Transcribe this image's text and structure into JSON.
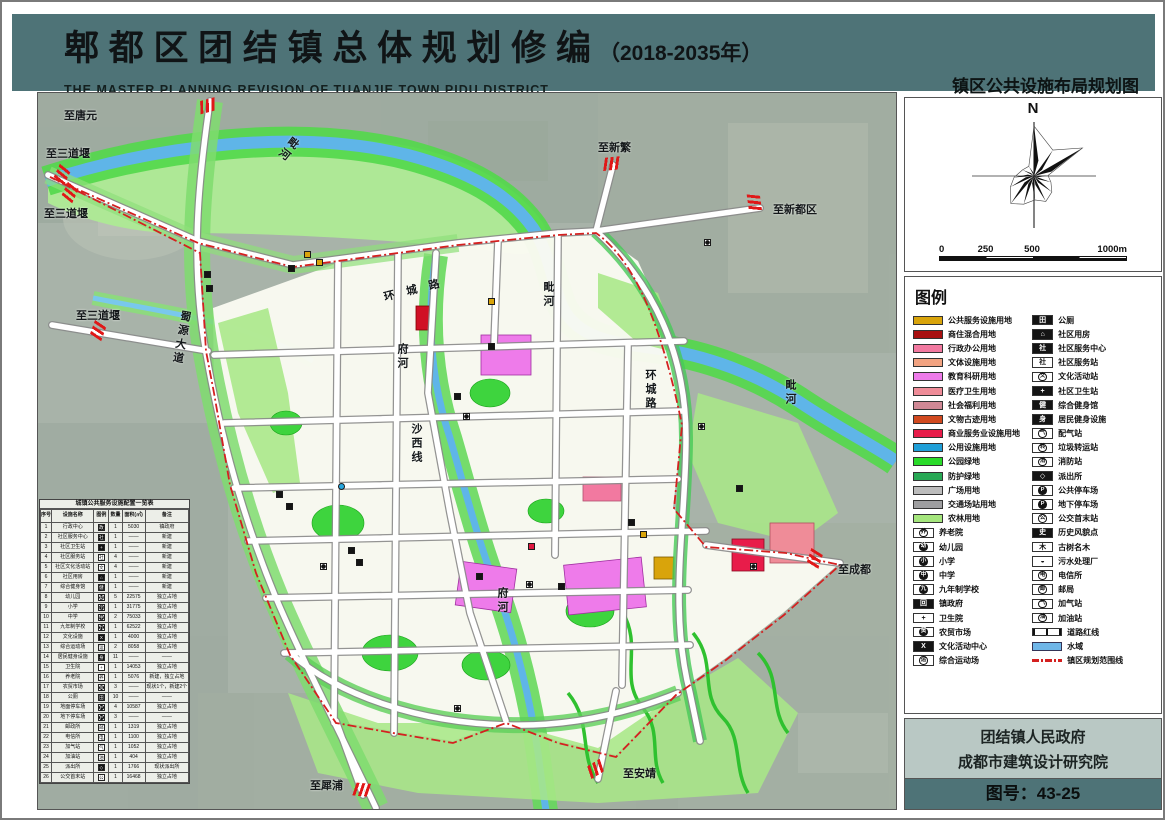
{
  "header": {
    "title": "郫 都 区 团 结 镇 总 体 规 划 修 编",
    "year_suffix": "（2018-2035年）",
    "subtitle_en": "THE MASTER PLANNING REVISION OF TUANJIE TOWN,PIDU DISTRICT",
    "map_name": "镇区公共设施布局规划图"
  },
  "compass": {
    "north_label": "N"
  },
  "scalebar": {
    "labels": [
      "0",
      "250",
      "500",
      "1000m"
    ]
  },
  "legend": {
    "title": "图例",
    "land_use": [
      {
        "label": "公共服务设施用地",
        "color": "#D9A40B"
      },
      {
        "label": "商住混合用地",
        "color": "#A81010"
      },
      {
        "label": "行政办公用地",
        "color": "#F279A0"
      },
      {
        "label": "文体设施用地",
        "color": "#F2A381"
      },
      {
        "label": "教育科研用地",
        "color": "#EE7BEA"
      },
      {
        "label": "医疗卫生用地",
        "color": "#EF8C98"
      },
      {
        "label": "社会福利用地",
        "color": "#D08895"
      },
      {
        "label": "文物古迹用地",
        "color": "#D1491F"
      },
      {
        "label": "商业服务业设施用地",
        "color": "#E81C4A"
      },
      {
        "label": "公用设施用地",
        "color": "#1F9FD8"
      },
      {
        "label": "公园绿地",
        "color": "#2ADB2A"
      },
      {
        "label": "防护绿地",
        "color": "#28A855"
      },
      {
        "label": "广场用地",
        "color": "#BCBCBC"
      },
      {
        "label": "交通场站用地",
        "color": "#9E9EA0"
      },
      {
        "label": "农林用地",
        "color": "#A5E67D"
      }
    ],
    "point_items_left": [
      {
        "label": "养老院",
        "glyph": "养",
        "kind": "c"
      },
      {
        "label": "幼儿园",
        "glyph": "幼",
        "kind": "d"
      },
      {
        "label": "小学",
        "glyph": "小",
        "kind": "d"
      },
      {
        "label": "中学",
        "glyph": "中",
        "kind": "d"
      },
      {
        "label": "九年制学校",
        "glyph": "九",
        "kind": "d"
      },
      {
        "label": "镇政府",
        "glyph": "回",
        "kind": "b"
      },
      {
        "label": "卫生院",
        "glyph": "+",
        "kind": "w"
      },
      {
        "label": "农贸市场",
        "glyph": "贸",
        "kind": "d"
      },
      {
        "label": "文化活动中心",
        "glyph": "X",
        "kind": "b"
      },
      {
        "label": "综合运动场",
        "glyph": "运",
        "kind": "c"
      }
    ],
    "point_items_right": [
      {
        "label": "公厕",
        "glyph": "田",
        "kind": "b"
      },
      {
        "label": "社区用房",
        "glyph": "⌂",
        "kind": "b"
      },
      {
        "label": "社区服务中心",
        "glyph": "社",
        "kind": "b"
      },
      {
        "label": "社区服务站",
        "glyph": "社",
        "kind": "w"
      },
      {
        "label": "文化活动站",
        "glyph": "文",
        "kind": "c"
      },
      {
        "label": "社区卫生站",
        "glyph": "+",
        "kind": "b"
      },
      {
        "label": "综合健身馆",
        "glyph": "健",
        "kind": "b"
      },
      {
        "label": "居民健身设施",
        "glyph": "身",
        "kind": "b"
      },
      {
        "label": "配气站",
        "glyph": "气",
        "kind": "c"
      },
      {
        "label": "垃圾转运站",
        "glyph": "转",
        "kind": "c"
      },
      {
        "label": "消防站",
        "glyph": "消",
        "kind": "c"
      },
      {
        "label": "派出所",
        "glyph": "◇",
        "kind": "b"
      },
      {
        "label": "公共停车场",
        "glyph": "P",
        "kind": "d"
      },
      {
        "label": "地下停车场",
        "glyph": "P",
        "kind": "d"
      },
      {
        "label": "公交首末站",
        "glyph": "公",
        "kind": "c"
      },
      {
        "label": "历史风貌点",
        "glyph": "史",
        "kind": "b"
      },
      {
        "label": "古树名木",
        "glyph": "木",
        "kind": "w"
      },
      {
        "label": "污水处理厂",
        "glyph": "◒",
        "kind": "w"
      },
      {
        "label": "电信所",
        "glyph": "电",
        "kind": "c"
      },
      {
        "label": "邮局",
        "glyph": "邮",
        "kind": "c"
      },
      {
        "label": "加气站",
        "glyph": "气",
        "kind": "c"
      },
      {
        "label": "加油站",
        "glyph": "油",
        "kind": "c"
      }
    ],
    "line_items": [
      {
        "label": "道路红线",
        "type": "roadline"
      },
      {
        "label": "水域",
        "type": "water",
        "color": "#6FB6E8"
      },
      {
        "label": "镇区规划范围线",
        "type": "boundary",
        "color": "#D42020"
      }
    ]
  },
  "map": {
    "labels": [
      {
        "text": "至唐元",
        "x": 26,
        "y": 14
      },
      {
        "text": "至三道堰",
        "x": 8,
        "y": 52
      },
      {
        "text": "至三道堰",
        "x": 6,
        "y": 112
      },
      {
        "text": "至三道堰",
        "x": 38,
        "y": 214
      },
      {
        "text": "至新繁",
        "x": 560,
        "y": 46
      },
      {
        "text": "至新都区",
        "x": 735,
        "y": 108
      },
      {
        "text": "至成都",
        "x": 800,
        "y": 468
      },
      {
        "text": "至安靖",
        "x": 585,
        "y": 672
      },
      {
        "text": "至犀浦",
        "x": 272,
        "y": 684
      },
      {
        "text": "毗河",
        "x": 252,
        "y": 40,
        "vertical": true,
        "rot": 38
      },
      {
        "text": "毗河",
        "x": 502,
        "y": 188,
        "vertical": true
      },
      {
        "text": "毗河",
        "x": 744,
        "y": 286,
        "vertical": true
      },
      {
        "text": "府河",
        "x": 356,
        "y": 250,
        "vertical": true
      },
      {
        "text": "府河",
        "x": 456,
        "y": 494,
        "vertical": true
      },
      {
        "text": "环城路",
        "x": 344,
        "y": 196,
        "rot": -14,
        "spread": true
      },
      {
        "text": "环城路",
        "x": 604,
        "y": 276,
        "vertical": true
      },
      {
        "text": "蜀源大道",
        "x": 140,
        "y": 216,
        "vertical": true,
        "rot": 10
      },
      {
        "text": "沙西线",
        "x": 370,
        "y": 330,
        "vertical": true
      }
    ],
    "arrows": [
      {
        "x": 162,
        "y": 6,
        "rot": -15
      },
      {
        "x": 16,
        "y": 74,
        "rot": -65
      },
      {
        "x": 24,
        "y": 92,
        "rot": -65
      },
      {
        "x": 52,
        "y": 230,
        "rot": -70
      },
      {
        "x": 566,
        "y": 64,
        "rot": -6
      },
      {
        "x": 708,
        "y": 104,
        "rot": 82
      },
      {
        "x": 768,
        "y": 460,
        "rot": 108
      },
      {
        "x": 548,
        "y": 670,
        "rot": 148
      },
      {
        "x": 314,
        "y": 690,
        "rot": 185
      }
    ],
    "markers": [
      {
        "x": 266,
        "y": 158,
        "k": "gold"
      },
      {
        "x": 278,
        "y": 166,
        "k": "gold"
      },
      {
        "x": 450,
        "y": 205,
        "k": "gold"
      },
      {
        "x": 602,
        "y": 438,
        "k": "gold"
      },
      {
        "x": 250,
        "y": 172,
        "k": "black"
      },
      {
        "x": 166,
        "y": 178,
        "k": "black"
      },
      {
        "x": 168,
        "y": 192,
        "k": "black"
      },
      {
        "x": 450,
        "y": 250,
        "k": "black"
      },
      {
        "x": 238,
        "y": 398,
        "k": "black"
      },
      {
        "x": 248,
        "y": 410,
        "k": "black"
      },
      {
        "x": 310,
        "y": 454,
        "k": "black"
      },
      {
        "x": 318,
        "y": 466,
        "k": "black"
      },
      {
        "x": 438,
        "y": 480,
        "k": "black"
      },
      {
        "x": 520,
        "y": 490,
        "k": "black"
      },
      {
        "x": 590,
        "y": 426,
        "k": "black"
      },
      {
        "x": 698,
        "y": 392,
        "k": "black"
      },
      {
        "x": 416,
        "y": 300,
        "k": "black"
      },
      {
        "x": 666,
        "y": 146,
        "k": "disc"
      },
      {
        "x": 425,
        "y": 320,
        "k": "disc"
      },
      {
        "x": 282,
        "y": 470,
        "k": "disc"
      },
      {
        "x": 488,
        "y": 488,
        "k": "disc"
      },
      {
        "x": 660,
        "y": 330,
        "k": "disc"
      },
      {
        "x": 712,
        "y": 470,
        "k": "disc"
      },
      {
        "x": 416,
        "y": 612,
        "k": "disc"
      },
      {
        "x": 300,
        "y": 390,
        "k": "blue"
      },
      {
        "x": 490,
        "y": 450,
        "k": "red"
      }
    ]
  },
  "table": {
    "title": "城镇公共服务设施配置一览表",
    "columns": [
      "序号",
      "设施名称",
      "图例",
      "数量",
      "面积(㎡)",
      "备注"
    ],
    "rows": [
      [
        "1",
        "行政中心",
        "b",
        "政",
        "1",
        "5030",
        "镇政府"
      ],
      [
        "2",
        "社区服务中心",
        "b",
        "社",
        "1",
        "——",
        "新建"
      ],
      [
        "3",
        "社区卫生站",
        "b",
        "+",
        "1",
        "——",
        "新建"
      ],
      [
        "4",
        "社区服务站",
        "w",
        "社",
        "4",
        "——",
        "新建"
      ],
      [
        "5",
        "社区文化活动站",
        "w",
        "文",
        "4",
        "——",
        "新建"
      ],
      [
        "6",
        "社区用房",
        "b",
        "⌂",
        "1",
        "——",
        "新建"
      ],
      [
        "7",
        "综合健身馆",
        "b",
        "健",
        "1",
        "——",
        "新建"
      ],
      [
        "8",
        "幼儿园",
        "d",
        "幼",
        "5",
        "22575",
        "独立占地"
      ],
      [
        "9",
        "小学",
        "d",
        "小",
        "1",
        "31775",
        "独立占地"
      ],
      [
        "10",
        "中学",
        "d",
        "中",
        "2",
        "75033",
        "独立占地"
      ],
      [
        "11",
        "九年制学校",
        "d",
        "九",
        "1",
        "62522",
        "独立占地"
      ],
      [
        "12",
        "文化设施",
        "b",
        "X",
        "1",
        "4000",
        "独立占地"
      ],
      [
        "13",
        "综合运动场",
        "c",
        "运",
        "2",
        "8058",
        "独立占地"
      ],
      [
        "14",
        "居民健身设施",
        "b",
        "身",
        "11",
        "——",
        "——"
      ],
      [
        "15",
        "卫生院",
        "w",
        "+",
        "1",
        "14053",
        "独立占地"
      ],
      [
        "16",
        "养老院",
        "c",
        "养",
        "1",
        "5076",
        "新建，独立占地"
      ],
      [
        "17",
        "农贸市场",
        "d",
        "贸",
        "3",
        "——",
        "现状1个，新建2个"
      ],
      [
        "18",
        "公厕",
        "b",
        "田",
        "10",
        "——",
        "——"
      ],
      [
        "19",
        "地面停车场",
        "d",
        "P",
        "4",
        "10587",
        "独立占地"
      ],
      [
        "20",
        "地下停车场",
        "d",
        "P",
        "3",
        "——",
        "——"
      ],
      [
        "21",
        "邮政所",
        "c",
        "邮",
        "1",
        "1319",
        "独立占地"
      ],
      [
        "22",
        "电信所",
        "c",
        "电",
        "1",
        "1100",
        "独立占地"
      ],
      [
        "23",
        "加气站",
        "c",
        "气",
        "1",
        "1052",
        "独立占地"
      ],
      [
        "24",
        "加油站",
        "c",
        "油",
        "1",
        "404",
        "独立占地"
      ],
      [
        "25",
        "派出所",
        "b",
        "◇",
        "1",
        "1766",
        "现状派出所"
      ],
      [
        "26",
        "公交首末站",
        "c",
        "公",
        "1",
        "16468",
        "独立占地"
      ]
    ]
  },
  "attribution": {
    "org_line1": "团结镇人民政府",
    "org_line2": "成都市建筑设计研究院",
    "drawing_no": "图号：43-25"
  },
  "colors": {
    "header_bg": "#4E7377",
    "boundary": "#D42020",
    "water": "#5FB5E8",
    "panel_bg": "#B9C8C4"
  }
}
